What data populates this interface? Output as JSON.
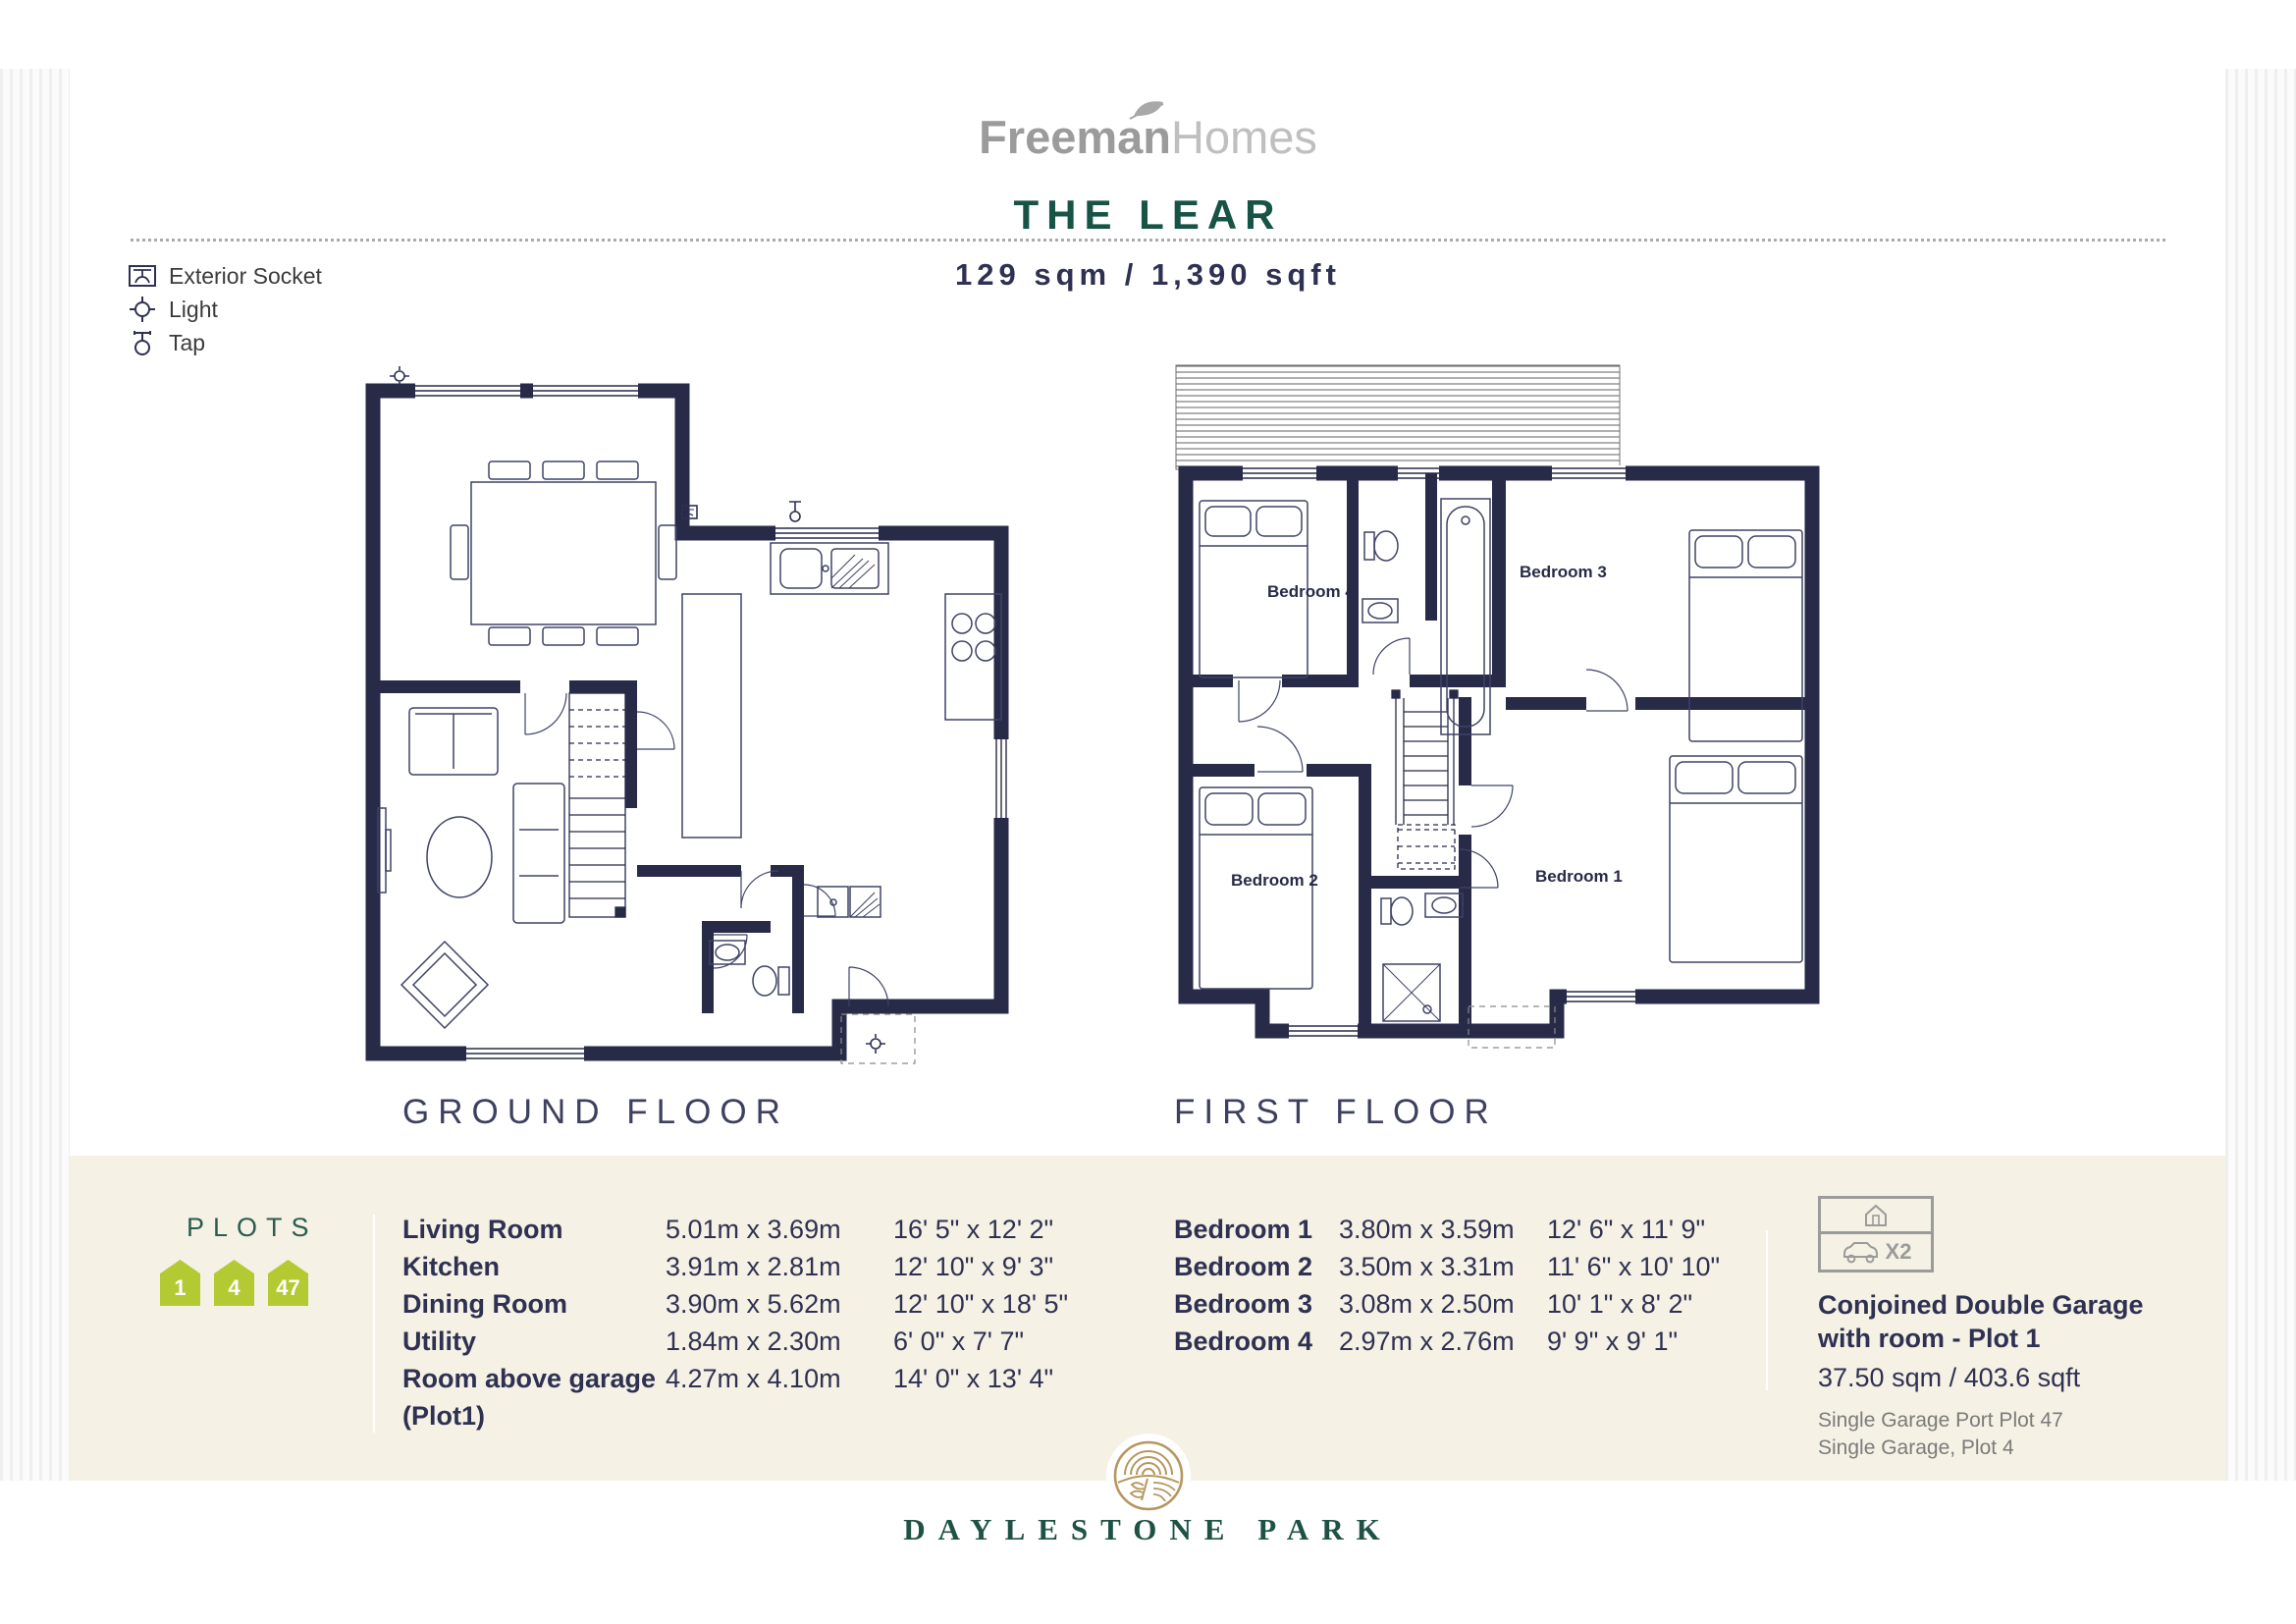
{
  "header": {
    "brand_bold": "Freeman",
    "brand_light": "Homes",
    "title": "THE LEAR",
    "size": "129 sqm / 1,390 sqft"
  },
  "legend": {
    "items": [
      {
        "icon": "exterior-socket-icon",
        "label": "Exterior Socket"
      },
      {
        "icon": "light-icon",
        "label": "Light"
      },
      {
        "icon": "tap-icon",
        "label": "Tap"
      }
    ]
  },
  "plans": {
    "ground": {
      "caption": "GROUND FLOOR"
    },
    "first": {
      "caption": "FIRST FLOOR",
      "rooms": {
        "bedroom1": "Bedroom 1",
        "bedroom2": "Bedroom 2",
        "bedroom3": "Bedroom 3",
        "bedroom4": "Bedroom 4"
      }
    }
  },
  "plots": {
    "heading": "PLOTS",
    "badges": [
      "1",
      "4",
      "47"
    ]
  },
  "dimensions": {
    "rooms": [
      {
        "name": "Living Room",
        "name2": "",
        "metric": "5.01m x 3.69m",
        "imperial": "16' 5\" x 12' 2\""
      },
      {
        "name": "Kitchen",
        "name2": "",
        "metric": "3.91m x 2.81m",
        "imperial": "12' 10\" x 9' 3\""
      },
      {
        "name": "Dining Room",
        "name2": "",
        "metric": "3.90m x 5.62m",
        "imperial": "12' 10\" x 18' 5\""
      },
      {
        "name": "Utility",
        "name2": "",
        "metric": "1.84m x 2.30m",
        "imperial": "6' 0\" x 7' 7\""
      },
      {
        "name": "Room above garage",
        "name2": "(Plot1)",
        "metric": "4.27m x 4.10m",
        "imperial": "14' 0\" x 13' 4\""
      }
    ],
    "bedrooms": [
      {
        "name": "Bedroom 1",
        "metric": "3.80m x 3.59m",
        "imperial": "12' 6\" x 11' 9\""
      },
      {
        "name": "Bedroom 2",
        "metric": "3.50m x 3.31m",
        "imperial": "11' 6\" x 10' 10\""
      },
      {
        "name": "Bedroom 3",
        "metric": "3.08m x 2.50m",
        "imperial": "10' 1\" x 8' 2\""
      },
      {
        "name": "Bedroom 4",
        "metric": "2.97m x 2.76m",
        "imperial": "9' 9\" x 9' 1\""
      }
    ]
  },
  "garage": {
    "multiplier": "X2",
    "title_line1": "Conjoined Double Garage",
    "title_line2": "with room - Plot 1",
    "size": "37.50 sqm / 403.6 sqft",
    "note1": "Single Garage Port Plot 47",
    "note2": "Single Garage, Plot 4"
  },
  "footer": {
    "brand": "DAYLESTONE PARK"
  },
  "colors": {
    "wall_navy": "#272b48",
    "title_green": "#175446",
    "badge_green": "#b3ca33",
    "band_beige": "#f5f1e4",
    "emblem_gold": "#b5975f"
  }
}
